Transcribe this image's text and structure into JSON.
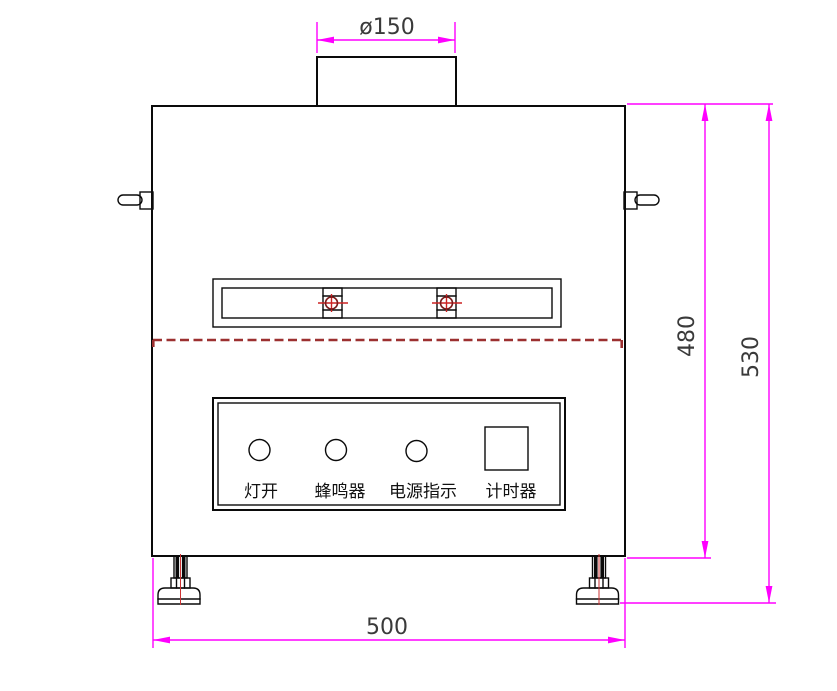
{
  "drawing": {
    "dimensions": {
      "duct_diameter_label": "ø150",
      "body_height_label": "480",
      "overall_height_label": "530",
      "width_label": "500"
    },
    "control_panel": {
      "labels": [
        "灯开",
        "蜂鸣器",
        "电源指示",
        "计时器"
      ]
    },
    "colors": {
      "dimension-color": "#ff00ff",
      "dim-text-color": "#3a3a3a",
      "outline-color": "#0a0a0a",
      "dashed-line-color": "#9c3030",
      "crosshair-color": "#cc2222",
      "crosshair-ring-color": "#7a1a1a",
      "centerline-color": "#cc3333"
    }
  }
}
